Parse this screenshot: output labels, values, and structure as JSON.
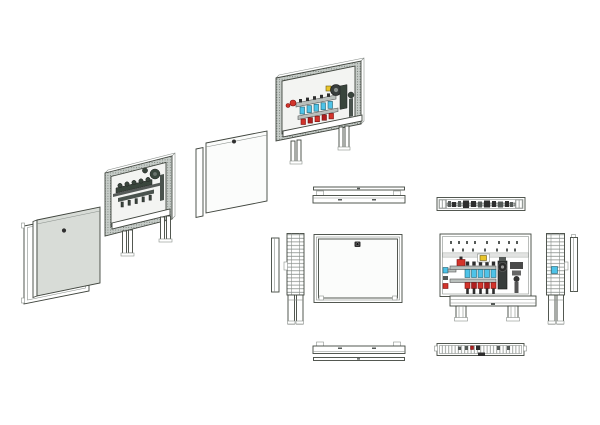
{
  "figure": {
    "type": "technical-drawing",
    "subject": "floor-heating manifold distribution cabinet",
    "text_visible": "",
    "views": [
      {
        "id": "exploded-iso-grey",
        "label": "Exploded isometric view - door frame, grey door panel and cabinet with manifold (greyscale)"
      },
      {
        "id": "exploded-iso-color",
        "label": "Exploded isometric view - white door panel and cabinet with colored manifold"
      },
      {
        "id": "ortho-closed",
        "label": "Orthographic projections of closed cabinet - top, left side, front with lock, bottom"
      },
      {
        "id": "ortho-open",
        "label": "Orthographic projections of open cabinet with manifold - top, front, right side, bottom"
      }
    ],
    "manifold": {
      "loops": 5,
      "rows": [
        "supply flow meters",
        "return valves"
      ],
      "pump": true
    }
  },
  "colors": {
    "paper": "#ffffff",
    "line": "#41463f",
    "line_soft": "#8a908c",
    "panel_grey": "#d8dcd7",
    "panel_white": "#fbfcfb",
    "interior": "#f3f4f2",
    "hatch_bg": "#c6ccc8",
    "hatch_dot": "#6d756f",
    "steel_grey": "#b9bfbc",
    "manifold_dark": "#39453c",
    "supply_cyan": "#4ec3e8",
    "valve_red": "#d2342b",
    "loop_red": "#b01f1f",
    "accent_yellow": "#e9c52b",
    "pump_dark": "#383d3c",
    "lock_dark": "#2f2f2f"
  }
}
